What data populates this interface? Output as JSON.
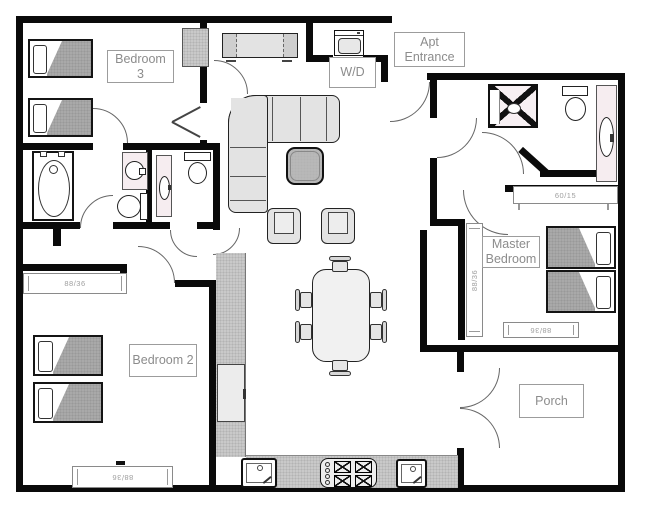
{
  "plan_type": "apartment-floor-plan",
  "rooms": {
    "bedroom3": "Bedroom 3",
    "bedroom2": "Bedroom 2",
    "master_bedroom": "Master Bedroom",
    "porch": "Porch",
    "apt_entrance": "Apt Entrance",
    "laundry": "W/D"
  },
  "dimensions": {
    "bedroom2_closet": "88/36",
    "bedroom2_window": "88/36",
    "master_window_side": "88/36",
    "master_window_bottom": "88/36",
    "master_closet": "60/15"
  },
  "colors": {
    "wall": "#0a0a0a",
    "label_border": "#9c9c9c",
    "label_text": "#8c8c8c",
    "counter": "#c9c9c9",
    "mattress": "#a9a9a9",
    "upholstery": "#e3e3e3",
    "coffee_table": "#b8b8b8",
    "vanity": "#f6edf0",
    "door_arc": "#666666"
  }
}
